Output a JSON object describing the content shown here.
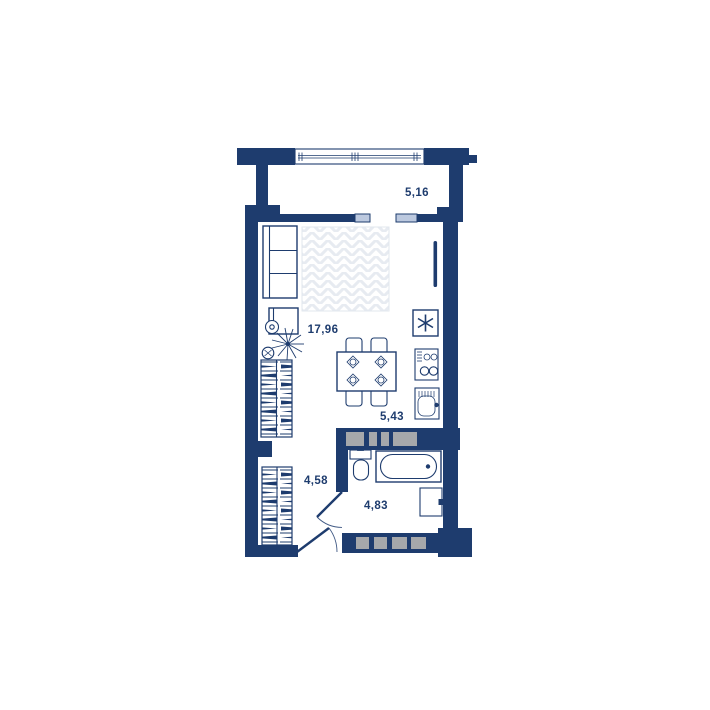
{
  "floor_plan": {
    "title": "studio-apartment-floor-plan",
    "balcony": {
      "area": "5,16"
    },
    "living_room": {
      "area": "17,96"
    },
    "kitchen": {
      "area": "5,43"
    },
    "hallway": {
      "area": "4,58"
    },
    "bathroom": {
      "area": "4,83"
    },
    "colors": {
      "wall_navy": "#1e3c6e",
      "window_fill": "#bcc9df",
      "vent_shaft_gray": "#a6a8ab",
      "bed_pattern": "#e7ebf1",
      "background": "#ffffff"
    },
    "icons": [
      "window-icon",
      "sofa-icon",
      "double-bed-icon",
      "desk-icon",
      "office-chair-icon",
      "plant-icon",
      "dining-table-icon",
      "dining-chair-icon",
      "place-setting-icon",
      "wardrobe-icon",
      "vent-hood-icon",
      "cooktop-icon",
      "kitchen-sink-icon",
      "toilet-icon",
      "bathtub-icon",
      "washing-machine-icon",
      "door-swing-icon",
      "balcony-door-leaf-icon",
      "vent-shaft-icon"
    ]
  }
}
